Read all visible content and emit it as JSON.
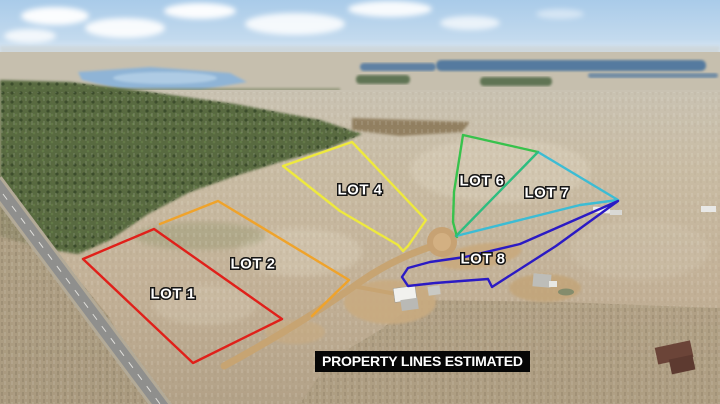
{
  "banner": {
    "text": "PROPERTY LINES ESTIMATED",
    "background": "#060606",
    "text_color": "#ffffff"
  },
  "scene": {
    "sky_color": "#b6d3ec",
    "haze_color": "#ccd5d9",
    "water_color": "#547a9f",
    "lake_color": "#8fb4d6",
    "terrain_color": "#c4b49a",
    "forest_color": "#586b41",
    "asphalt_road_color": "#8f8f8d",
    "gravel_road_color": "#c7a472"
  },
  "lots": [
    {
      "label": "LOT 1",
      "color": "#e0201a",
      "closed": true,
      "label_x": 173,
      "label_y": 294,
      "points": "83,259 154,229 282,319 193,363"
    },
    {
      "label": "LOT 2",
      "color": "#efa32b",
      "closed": false,
      "label_x": 253,
      "label_y": 264,
      "points": "160,224 218,201 349,280 312,316"
    },
    {
      "label": "LOT 4",
      "color": "#eee93e",
      "closed": true,
      "label_x": 360,
      "label_y": 190,
      "points": "352,142 426,220 417,233 408,246 403,251 398,245 340,211 283,166"
    },
    {
      "label": "LOT 6",
      "color": "#38c24c",
      "closed": false,
      "label_x": 482,
      "label_y": 181,
      "points": "457,237 453,222 454,192 463,135 538,152"
    },
    {
      "label": "LOT 7",
      "color": "#3cbcd4",
      "closed": false,
      "label_x": 547,
      "label_y": 193,
      "points": "538,152 618,200 580,205 456,236"
    },
    {
      "label": "LOT 8",
      "color": "#2b1ac4",
      "closed": true,
      "label_x": 483,
      "label_y": 259,
      "points": "618,201 520,244 465,257 430,262 408,268 402,277 408,286 435,283 488,279 492,287 556,246"
    }
  ],
  "shared_lines": [
    {
      "name": "lot6-lot7-boundary",
      "color": "#2dbd80",
      "points": "456,236 538,152"
    }
  ]
}
